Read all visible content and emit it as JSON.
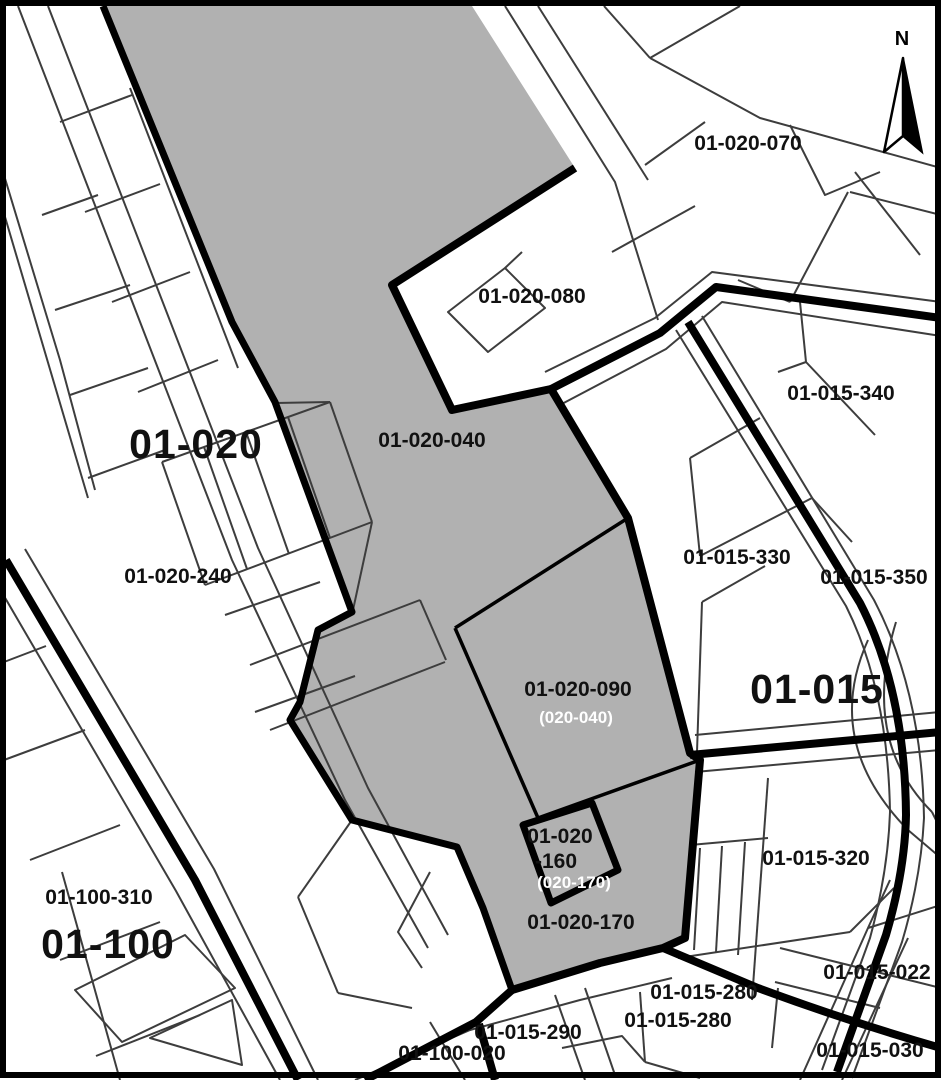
{
  "map": {
    "colors": {
      "highlight_fill": "#b1b1b1",
      "parcel_line": "#3d3d3d",
      "boundary": "#000000",
      "background": "#ffffff",
      "label": "#111111",
      "sub_label": "#ffffff"
    },
    "north": {
      "label": "N"
    },
    "district_labels": {
      "d01_020": "01-020",
      "d01_015": "01-015",
      "d01_100": "01-100"
    },
    "parcel_labels": {
      "p070": "01-020-070",
      "p080": "01-020-080",
      "p040": "01-020-040",
      "p340": "01-015-340",
      "p240": "01-020-240",
      "p330": "01-015-330",
      "p350": "01-015-350",
      "p090": "01-020-090",
      "p160_line1": "01-020",
      "p160_line2": "-160",
      "p170": "01-020-170",
      "p320": "01-015-320",
      "p310": "01-100-310",
      "p290": "01-015-290",
      "p280a": "01-015-280",
      "p280b": "01-015-280",
      "p020": "01-100-020",
      "p022": "01-015-022",
      "p030": "01-015-030"
    },
    "sub_labels": {
      "s090": "(020-040)",
      "s160": "(020-170)"
    }
  }
}
